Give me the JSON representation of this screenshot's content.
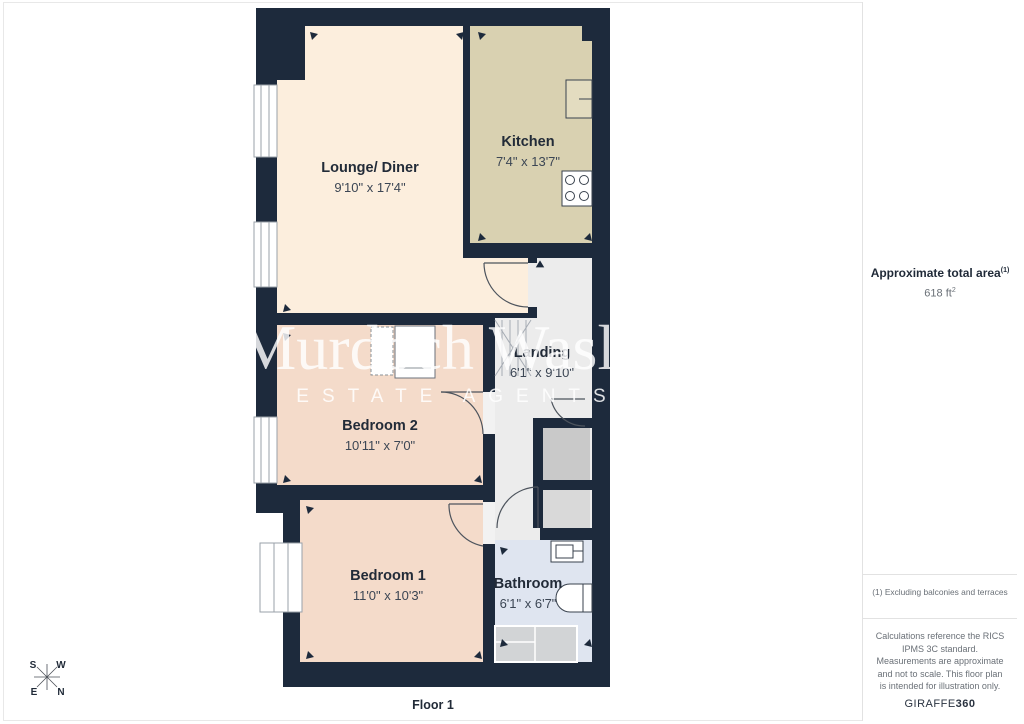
{
  "floor": {
    "label": "Floor 1"
  },
  "watermark": {
    "name": "Murdoch Wasley",
    "tagline": "ESTATE AGENTS"
  },
  "compass": {
    "n": "N",
    "s": "S",
    "e": "E",
    "w": "W"
  },
  "rooms": {
    "lounge": {
      "label": "Lounge/ Diner",
      "dims": "9'10\" x 17'4\""
    },
    "kitchen": {
      "label": "Kitchen",
      "dims": "7'4\" x 13'7\""
    },
    "landing": {
      "label": "Landing",
      "dims": "6'1\" x 9'10\""
    },
    "bedroom2": {
      "label": "Bedroom 2",
      "dims": "10'11\" x 7'0\""
    },
    "bedroom1": {
      "label": "Bedroom 1",
      "dims": "11'0\" x 10'3\""
    },
    "bathroom": {
      "label": "Bathroom",
      "dims": "6'1\" x 6'7\""
    }
  },
  "sidebar": {
    "area_label": "Approximate total area",
    "area_footnote_marker": "(1)",
    "area_value": "618 ft",
    "area_value_exponent": "2",
    "footnote": "(1) Excluding balconies and terraces",
    "disclaimer": "Calculations reference the RICS IPMS 3C standard. Measurements are approximate and not to scale. This floor plan is intended for illustration only.",
    "brand": "GIRAFFE",
    "brand_bold": "360"
  },
  "colors": {
    "wall": "#1d2a3c",
    "lounge_floor": "#fceedd",
    "kitchen_floor": "#d9d1b1",
    "bedroom_floor": "#f4dbca",
    "hall_floor": "#ececec",
    "bathroom_floor": "#dfe5f0",
    "cupboard_gray": "#c9c9c9"
  }
}
